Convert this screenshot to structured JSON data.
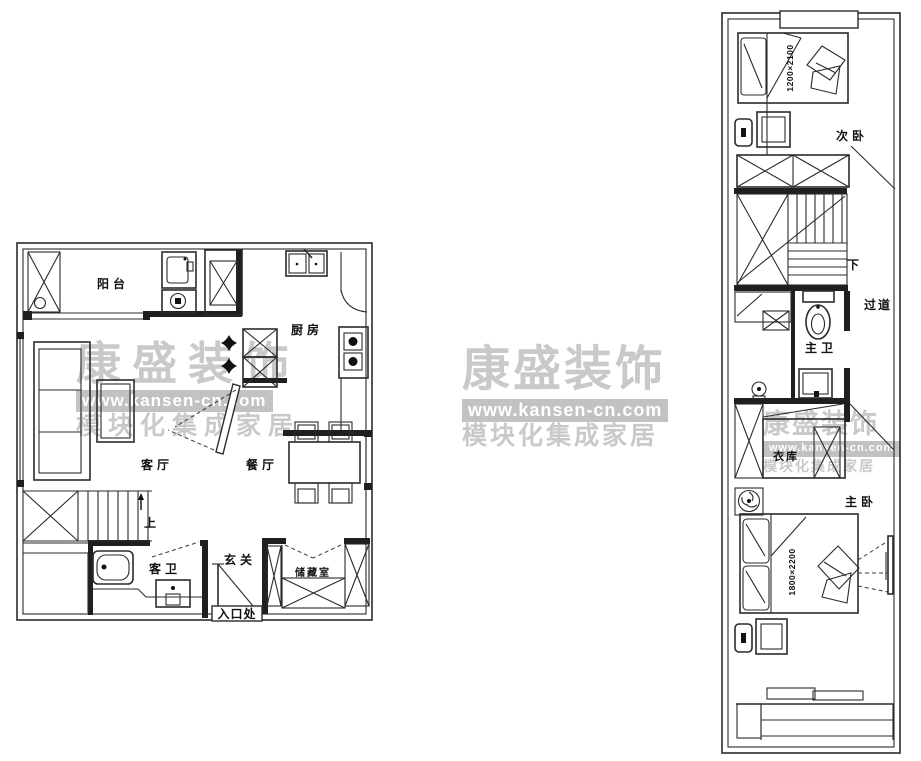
{
  "watermark": {
    "brand": "康盛装饰",
    "url": "www.kansen-cn.com",
    "tagline": "模块化集成家居"
  },
  "floor1": {
    "rooms": {
      "balcony": "阳台",
      "kitchen": "厨房",
      "living": "客厅",
      "dining": "餐厅",
      "foyer": "玄关",
      "guest_bath": "客卫",
      "storage": "储藏室",
      "entrance": "入口处",
      "stairs_up": "上"
    }
  },
  "floor2": {
    "rooms": {
      "second_bedroom": "次卧",
      "stairs_down": "下",
      "hallway": "过道",
      "master_bath": "主卫",
      "wardrobe": "衣库",
      "master_bedroom": "主卧"
    },
    "dimensions": {
      "second_bed": "1200×2100",
      "master_bed": "1800×2200"
    }
  },
  "colors": {
    "line": "#2b2b2b",
    "watermark_text": "#c9c9c9",
    "watermark_bar": "#c2c2c2"
  }
}
